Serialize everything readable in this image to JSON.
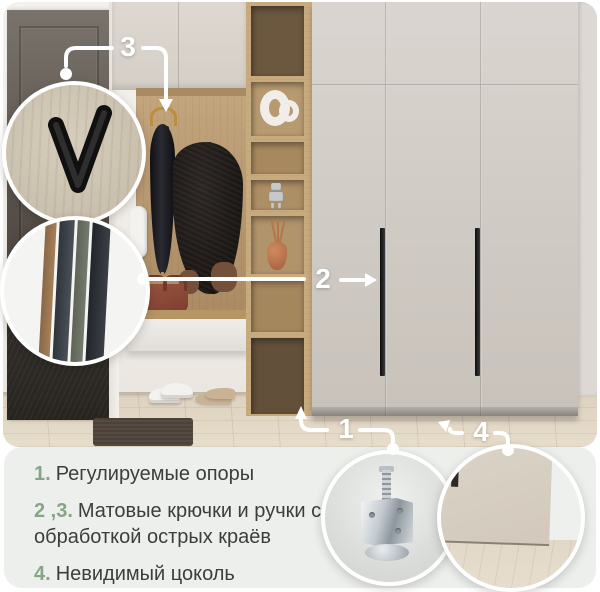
{
  "callouts": {
    "c1": "1",
    "c2": "2",
    "c3": "3",
    "c4": "4"
  },
  "features": [
    {
      "num": "1.",
      "text": "Регулируемые опоры"
    },
    {
      "num": "2 ,3.",
      "text": "Матовые крючки и ручки с обработкой острых краёв"
    },
    {
      "num": "4.",
      "text": "Невидимый цоколь"
    }
  ],
  "colors": {
    "accent_green": "#84a687",
    "callout_white": "#ffffff",
    "legend_bg": "#edefec",
    "text": "#3d3d3d"
  },
  "insets": {
    "hook": "v-hook-closeup",
    "profiles": "handle-profiles-closeup",
    "foot": "adjustable-foot-closeup",
    "plinth": "invisible-plinth-closeup"
  }
}
